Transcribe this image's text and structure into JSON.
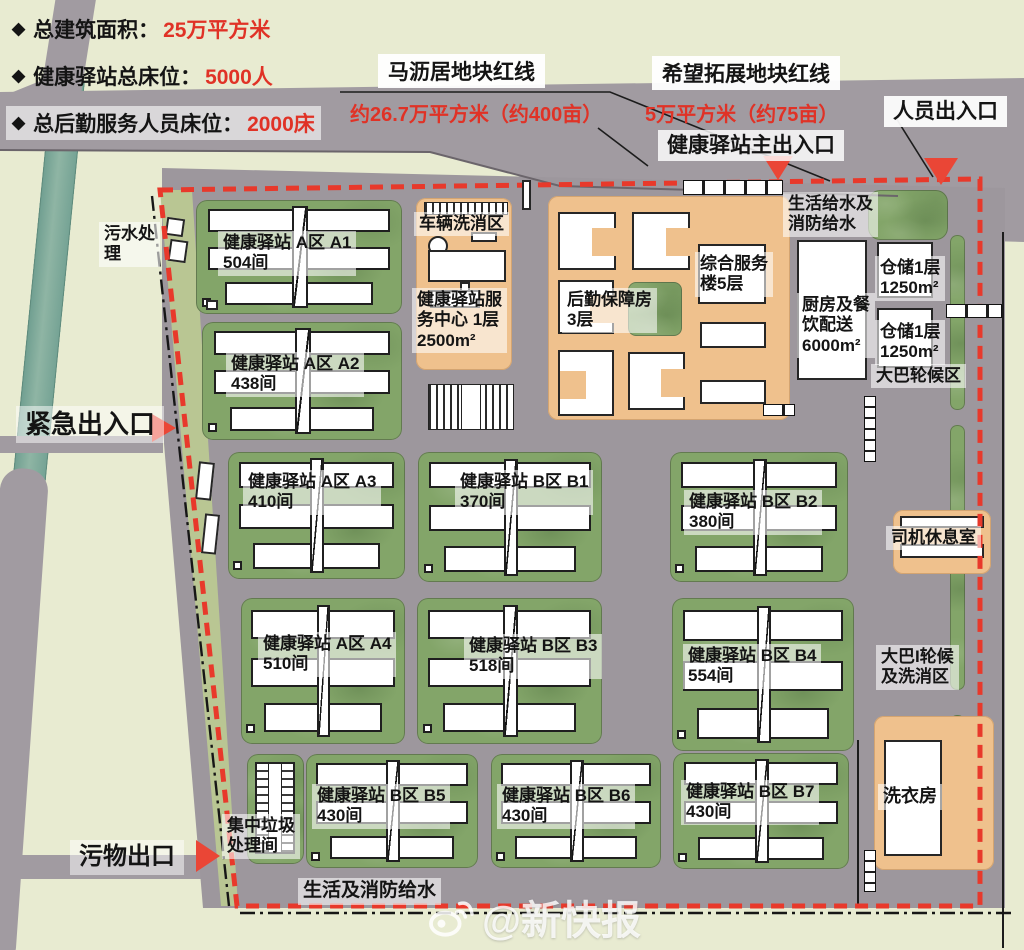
{
  "legend": {
    "bullet": "◆",
    "items": [
      {
        "label": "总建筑面积：",
        "value": "25万平方米"
      },
      {
        "label": "健康驿站总床位：",
        "value": "5000人"
      },
      {
        "label": "总后勤服务人员床位：",
        "value": "2000床"
      }
    ]
  },
  "plots": {
    "p1_title": "马沥居地块红线",
    "p1_area": "约26.7万平方米（约400亩）",
    "p2_title": "希望拓展地块红线",
    "p2_area": "5万平方米（约75亩）"
  },
  "entrances": {
    "person": "人员出入口",
    "main": "健康驿站主出入口",
    "emergency": "紧急出入口",
    "waste": "污物出口"
  },
  "blocks": [
    {
      "id": "a1",
      "line1": "健康驿站 A区 A1",
      "line2": "504间"
    },
    {
      "id": "a2",
      "line1": "健康驿站 A区 A2",
      "line2": "438间"
    },
    {
      "id": "a3",
      "line1": "健康驿站 A区 A3",
      "line2": "410间"
    },
    {
      "id": "a4",
      "line1": "健康驿站 A区 A4",
      "line2": "510间"
    },
    {
      "id": "b1",
      "line1": "健康驿站 B区 B1",
      "line2": "370间"
    },
    {
      "id": "b2",
      "line1": "健康驿站 B区 B2",
      "line2": "380间"
    },
    {
      "id": "b3",
      "line1": "健康驿站 B区 B3",
      "line2": "518间"
    },
    {
      "id": "b4",
      "line1": "健康驿站 B区 B4",
      "line2": "554间"
    },
    {
      "id": "b5",
      "line1": "健康驿站 B区 B5",
      "line2": "430间"
    },
    {
      "id": "b6",
      "line1": "健康驿站 B区 B6",
      "line2": "430间"
    },
    {
      "id": "b7",
      "line1": "健康驿站 B区 B7",
      "line2": "430间"
    }
  ],
  "facilities": {
    "sewage_l1": "污水处",
    "sewage_l2": "理",
    "vehicle_wash": "车辆洗消区",
    "service_center_l1": "健康驿站服",
    "service_center_l2": "务中心 1层",
    "service_center_l3": "2500m²",
    "logistics_l1": "后勤保障房",
    "logistics_l2": "3层",
    "complex_l1": "综合服务",
    "complex_l2": "楼5层",
    "water_supply_l1": "生活给水及",
    "water_supply_l2": "消防给水",
    "kitchen_l1": "厨房及餐",
    "kitchen_l2": "饮配送",
    "kitchen_l3": "6000m²",
    "storage1_l1": "仓储1层",
    "storage1_l2": "1250m²",
    "storage2_l1": "仓储1层",
    "storage2_l2": "1250m²",
    "bus_wait": "大巴轮候区",
    "driver_rest": "司机休息室",
    "bus_wash_l1": "大巴I轮候",
    "bus_wash_l2": "及洗消区",
    "laundry": "洗衣房",
    "garbage_l1": "集中垃圾",
    "garbage_l2": "处理间",
    "water_bottom": "生活及消防给水"
  },
  "watermark": "@新快报",
  "colors": {
    "boundary_red": "#e8392b",
    "accent_red": "#e03226",
    "road_gray": "#a19ba1",
    "grass_green": "#83a569",
    "zone_orange": "#efc18d",
    "river_teal": "#7fa99a"
  }
}
